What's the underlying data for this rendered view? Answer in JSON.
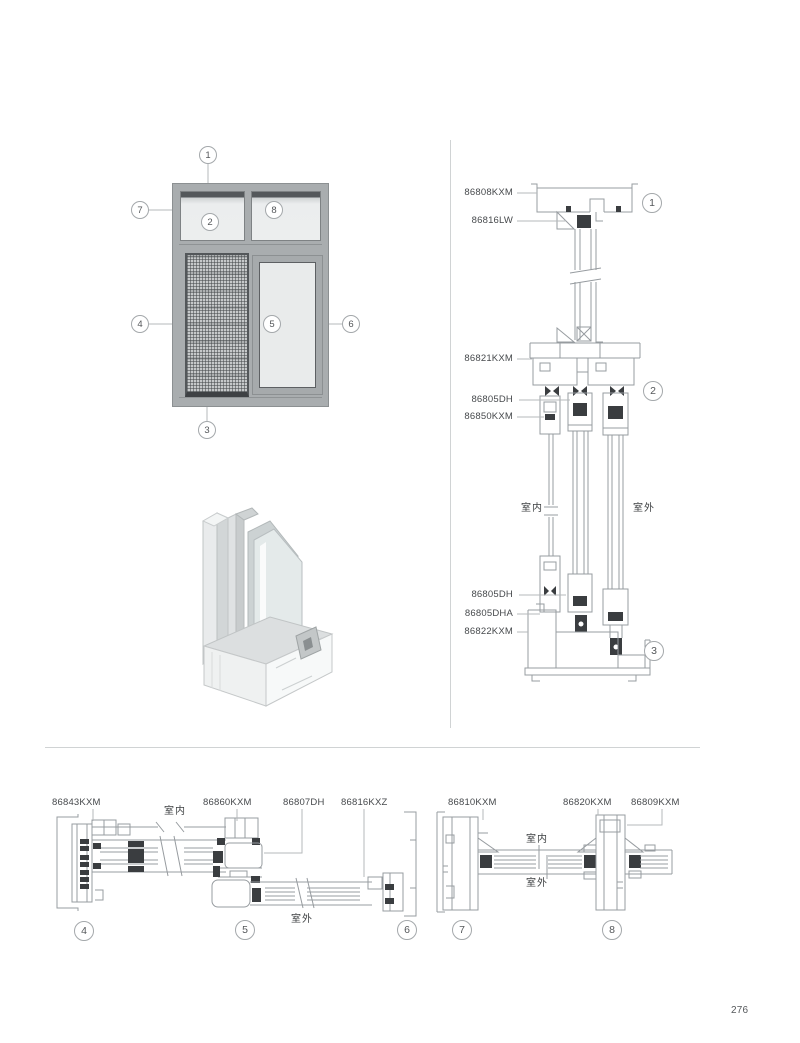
{
  "page": {
    "number": "276"
  },
  "elevation": {
    "callouts": [
      "1",
      "2",
      "3",
      "4",
      "5",
      "6",
      "7",
      "8"
    ]
  },
  "vertical_section": {
    "labels": [
      "86808KXM",
      "86816LW",
      "86821KXM",
      "86805DH",
      "86850KXM",
      "86805DH",
      "86805DHA",
      "86822KXM"
    ],
    "indoor": "室内",
    "outdoor": "室外",
    "callouts": [
      "1",
      "2",
      "3"
    ]
  },
  "bottom_left_section": {
    "labels": [
      "86843KXM",
      "86860KXM",
      "86807DH",
      "86816KXZ"
    ],
    "indoor": "室内",
    "outdoor": "室外",
    "callouts": [
      "4",
      "5",
      "6"
    ]
  },
  "bottom_right_section": {
    "labels": [
      "86810KXM",
      "86820KXM",
      "86809KXM"
    ],
    "indoor": "室内",
    "outdoor": "室外",
    "callouts": [
      "7",
      "8"
    ]
  }
}
